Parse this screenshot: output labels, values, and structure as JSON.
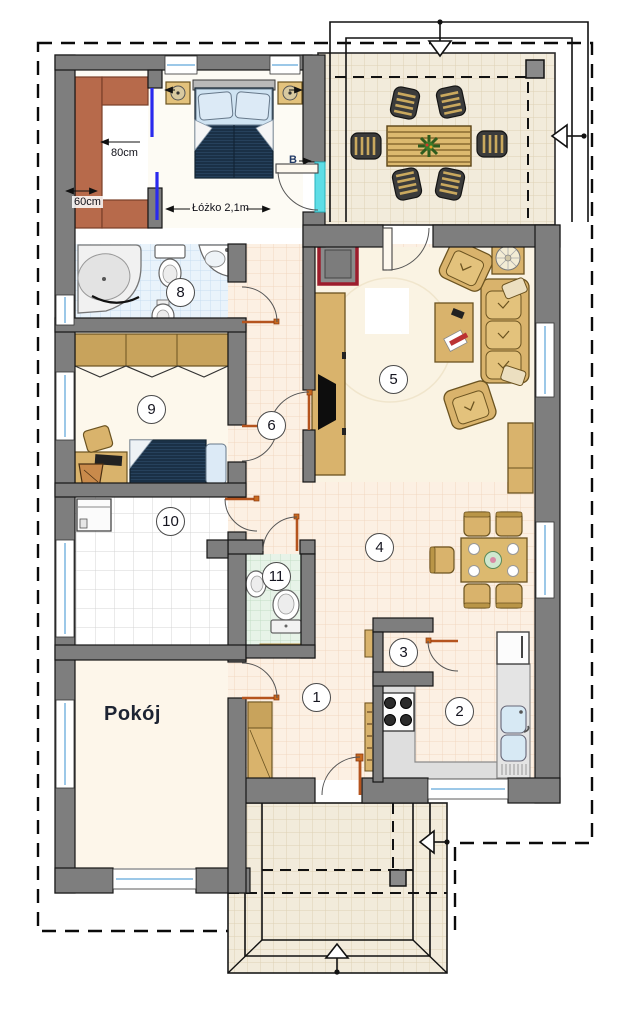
{
  "floor_plan": {
    "room_numbers": [
      {
        "id": "hall",
        "label": "1"
      },
      {
        "id": "kitchen",
        "label": "2"
      },
      {
        "id": "pantry",
        "label": "3"
      },
      {
        "id": "dining",
        "label": "4"
      },
      {
        "id": "living",
        "label": "5"
      },
      {
        "id": "corridor",
        "label": "6"
      },
      {
        "id": "bathroom",
        "label": "8"
      },
      {
        "id": "small-bedroom",
        "label": "9"
      },
      {
        "id": "utility",
        "label": "10"
      },
      {
        "id": "wc",
        "label": "11"
      }
    ],
    "labels": {
      "room_name": "Pokój",
      "closet_depth": "80cm",
      "closet_width": "60cm",
      "bed_length": "Łóżko 2,1m",
      "section_marker": "B"
    },
    "colors": {
      "wall": "#7e7e7e",
      "door_swing_accent": "#b5541e",
      "sliding_door": "#2a2aee",
      "balcony_door_highlight": "#5fdde6",
      "fireplace_frame": "#9c1c2c",
      "furniture_wood": "#d9b36c",
      "wardrobe_terracotta": "#b76a4b",
      "bed_navy": "#26415c",
      "bathroom_tile": "#e9f3fb",
      "wc_tile": "#e7f3e8",
      "hall_tile": "#fcf0e3",
      "terrace_tile": "#f2ebdb"
    }
  }
}
